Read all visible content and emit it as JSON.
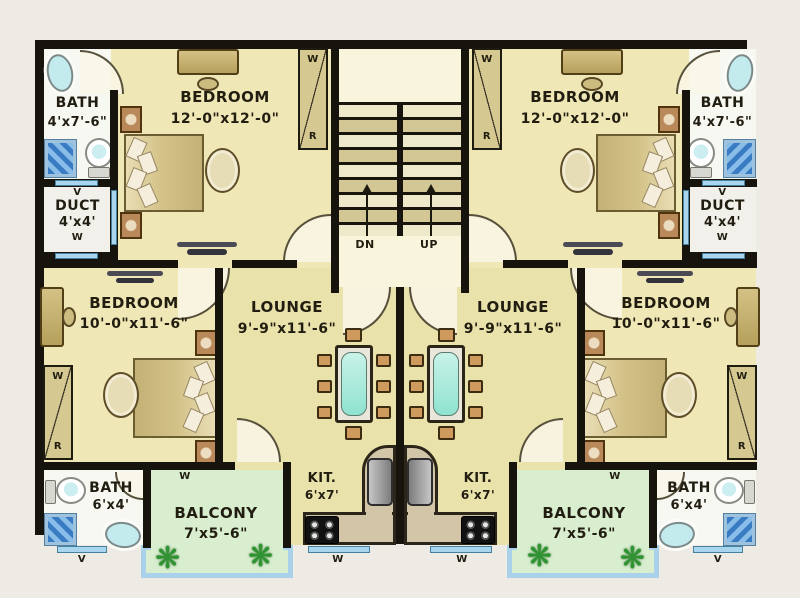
{
  "rooms": {
    "bath_top": {
      "name": "BATH",
      "dims": "4'x7'-6\""
    },
    "bedroom_top": {
      "name": "BEDROOM",
      "dims": "12'-0\"x12'-0\""
    },
    "duct": {
      "name": "DUCT",
      "dims": "4'x4'"
    },
    "bedroom_mid": {
      "name": "BEDROOM",
      "dims": "10'-0\"x11'-6\""
    },
    "lounge": {
      "name": "LOUNGE",
      "dims": "9'-9\"x11'-6\""
    },
    "bath_bottom": {
      "name": "BATH",
      "dims": "6'x4'"
    },
    "balcony": {
      "name": "BALCONY",
      "dims": "7'x5'-6\""
    },
    "kitchen": {
      "name": "KIT.",
      "dims": "6'x7'"
    }
  },
  "stairs": {
    "down": "DN",
    "up": "UP"
  },
  "letters": {
    "window": "W",
    "vent": "V",
    "rack": "R"
  },
  "icons": {
    "plant": "❋"
  },
  "colors": {
    "wall": "#16140c",
    "bedroom_floor": "#f0e7b6",
    "lounge_floor": "#e9e2ab",
    "bath_floor": "#f8f8f3",
    "balcony_floor": "#d9edcf",
    "window_blue": "#aad5ef",
    "railing_blue": "#a9d2ea",
    "table_glass": "#9fe9da",
    "stair_landing": "#f9f5dc",
    "background": "#edebe4"
  }
}
